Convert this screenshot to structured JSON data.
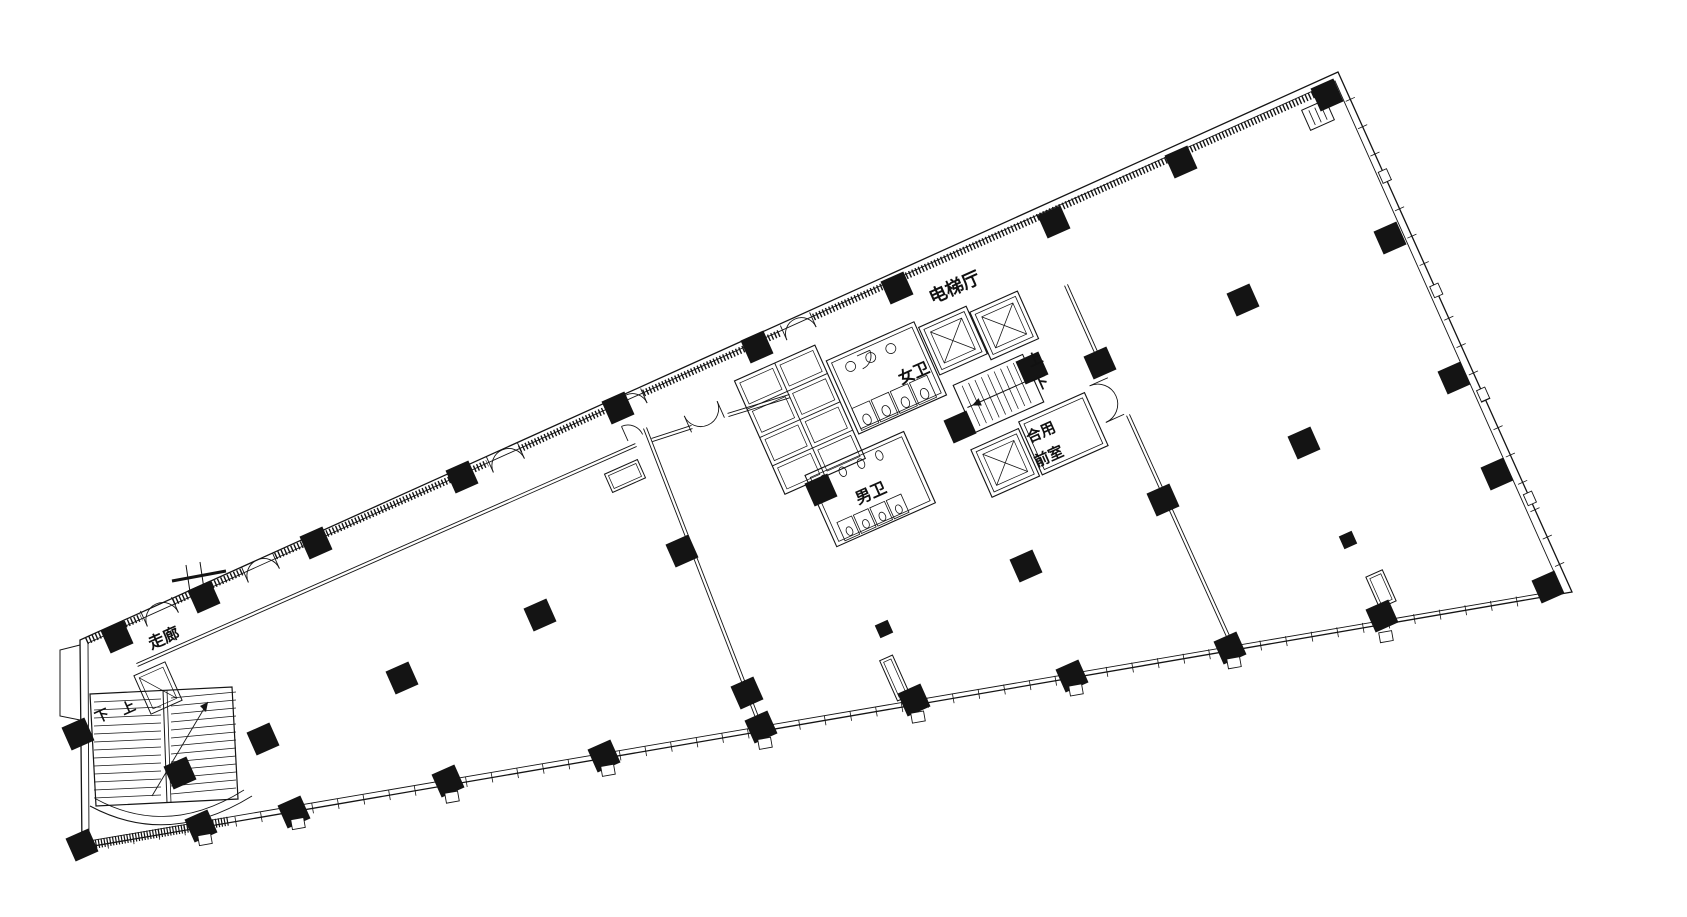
{
  "labels": {
    "elevator_hall": "电梯厅",
    "womens_wc": "女卫",
    "mens_wc": "男卫",
    "shared_vestibule_line1": "合用",
    "shared_vestibule_line2": "前室",
    "core_up": "上",
    "core_down": "下",
    "corridor": "走廊",
    "bl_down": "下",
    "bl_up": "上"
  },
  "plan": {
    "stroke": "#141414",
    "bg": "#ffffff",
    "canvas": [
      1687,
      917
    ],
    "outline_outer": [
      [
        80,
        640
      ],
      [
        82,
        848
      ],
      [
        1572,
        592
      ],
      [
        1338,
        72
      ]
    ],
    "outline_inner": [
      [
        88,
        643
      ],
      [
        89,
        841
      ],
      [
        1562,
        590
      ],
      [
        1335,
        81
      ]
    ],
    "notch": [
      [
        80,
        645
      ],
      [
        60,
        650
      ],
      [
        60,
        716
      ],
      [
        80,
        720
      ]
    ],
    "curtain_segments": [
      [
        85,
        638,
        140,
        614
      ],
      [
        172,
        599,
        242,
        568
      ],
      [
        274,
        553,
        486,
        460
      ],
      [
        518,
        446,
        608,
        405
      ],
      [
        642,
        390,
        778,
        330
      ],
      [
        812,
        314,
        1320,
        88
      ]
    ],
    "tick_edges": [
      {
        "x1": 82,
        "y1": 848,
        "x2": 1572,
        "y2": 592,
        "step": 26,
        "len": 10
      },
      {
        "x1": 1338,
        "y1": 72,
        "x2": 1572,
        "y2": 592,
        "step": 30,
        "len": 10
      }
    ],
    "partitions": [
      [
        645,
        428,
        760,
        725
      ],
      [
        1066,
        285,
        1104,
        370
      ],
      [
        1128,
        415,
        1232,
        645
      ],
      [
        137,
        665,
        636,
        445
      ],
      [
        652,
        440,
        692,
        427
      ],
      [
        728,
        415,
        790,
        396
      ]
    ],
    "doors": [
      {
        "x": 156,
        "y": 604,
        "a": 156,
        "r": 17,
        "d": 2
      },
      {
        "x": 257,
        "y": 560,
        "a": 156,
        "r": 17,
        "d": 2
      },
      {
        "x": 502,
        "y": 450,
        "a": 156,
        "r": 17,
        "d": 2
      },
      {
        "x": 626,
        "y": 395,
        "a": 156,
        "r": 16,
        "d": 2
      },
      {
        "x": 795,
        "y": 319,
        "a": 156,
        "r": 16,
        "d": 2
      },
      {
        "x": 628,
        "y": 441,
        "a": -24,
        "r": 16,
        "d": 1
      },
      {
        "x": 708,
        "y": 425,
        "a": -24,
        "r": 18,
        "d": 2
      },
      {
        "x": 857,
        "y": 356,
        "a": 66,
        "r": 14,
        "d": 1
      },
      {
        "x": 1116,
        "y": 396,
        "a": -114,
        "r": 20,
        "d": 2
      }
    ],
    "columns": [
      [
        117,
        637
      ],
      [
        204,
        597
      ],
      [
        316,
        543
      ],
      [
        462,
        477
      ],
      [
        618,
        408
      ],
      [
        757,
        347
      ],
      [
        897,
        288
      ],
      [
        1054,
        222
      ],
      [
        1181,
        162
      ],
      [
        1327,
        95
      ],
      [
        1390,
        238
      ],
      [
        1454,
        378
      ],
      [
        1497,
        474
      ],
      [
        1548,
        587
      ],
      [
        82,
        845
      ],
      [
        201,
        826
      ],
      [
        294,
        812
      ],
      [
        448,
        781
      ],
      [
        604,
        756
      ],
      [
        761,
        727
      ],
      [
        914,
        700
      ],
      [
        1072,
        676
      ],
      [
        1230,
        648
      ],
      [
        1382,
        616
      ],
      [
        263,
        739
      ],
      [
        402,
        678
      ],
      [
        540,
        615
      ],
      [
        682,
        551
      ],
      [
        747,
        693
      ],
      [
        1026,
        566
      ],
      [
        1243,
        300
      ],
      [
        1304,
        443
      ],
      [
        1032,
        368
      ],
      [
        1100,
        363
      ],
      [
        821,
        490
      ],
      [
        1163,
        500
      ],
      [
        180,
        773
      ],
      [
        78,
        734
      ],
      [
        960,
        427
      ]
    ],
    "columns_small": [
      [
        884,
        629
      ],
      [
        1348,
        540
      ]
    ],
    "window_squares_bottom_x": [
      201,
      294,
      448,
      604,
      761,
      914,
      1072,
      1230,
      1382
    ],
    "right_squares": [
      0.2,
      0.42,
      0.62,
      0.82
    ],
    "core": {
      "cx": 940,
      "cy": 400,
      "angle": -24,
      "rooms": [
        {
          "t": "shaft",
          "x": 950,
          "y": 325,
          "w": 52,
          "h": 52
        },
        {
          "t": "shaft",
          "x": 1003,
          "y": 332,
          "w": 52,
          "h": 52
        },
        {
          "t": "stair",
          "x": 958,
          "y": 392,
          "w": 76,
          "h": 52
        },
        {
          "t": "shaft",
          "x": 948,
          "y": 458,
          "w": 52,
          "h": 52
        },
        {
          "t": "room",
          "x": 1003,
          "y": 452,
          "w": 72,
          "h": 58
        },
        {
          "t": "room",
          "x": 852,
          "y": 318,
          "w": 96,
          "h": 80
        },
        {
          "t": "room",
          "x": 786,
          "y": 414,
          "w": 108,
          "h": 78
        },
        {
          "t": "grid",
          "x": 760,
          "y": 299,
          "w": 88,
          "h": 124,
          "cols": 2,
          "rows": 4
        }
      ],
      "stalls_f": {
        "x": 856,
        "y": 372,
        "n": 4,
        "w": 21,
        "h": 24
      },
      "sinks_f": {
        "x": 872,
        "y": 333,
        "n": 3,
        "s": 22
      },
      "urinals_m": {
        "x": 802,
        "y": 426,
        "n": 4,
        "s": 20
      },
      "stalls_m": {
        "x": 796,
        "y": 470,
        "n": 4,
        "w": 18,
        "h": 20
      }
    },
    "stubs": [
      {
        "x": 625,
        "y": 476,
        "w": 36,
        "h": 20,
        "a": -24
      },
      {
        "x": 895,
        "y": 678,
        "w": 14,
        "h": 44,
        "a": -24
      },
      {
        "x": 1381,
        "y": 589,
        "w": 18,
        "h": 34,
        "a": -24
      }
    ],
    "bl_stair": {
      "outer": [
        [
          90,
          694
        ],
        [
          232,
          687
        ],
        [
          238,
          799
        ],
        [
          96,
          806
        ]
      ],
      "div": [
        163,
        690,
        167,
        803
      ],
      "treadsA": {
        "x1": 94,
        "x2": 161,
        "y0": 702,
        "y1": 798,
        "step": 8,
        "drop": 3
      },
      "treadsB": {
        "x1": 171,
        "x2": 236,
        "y0": 698,
        "y1": 796,
        "step": 8,
        "drop": 6
      },
      "arrow": [
        152,
        796,
        208,
        702
      ],
      "curve1": "M90,806 Q168,848 252,796",
      "curve2": "M96,799 Q168,838 244,790",
      "shaft": {
        "cx": 158,
        "cy": 688,
        "w": 34,
        "h": 42
      }
    },
    "cut_mark": {
      "bar": [
        172,
        581,
        226,
        571
      ],
      "t1": [
        186,
        565,
        190,
        592
      ],
      "t2": [
        200,
        562,
        204,
        589
      ]
    },
    "corner_box": {
      "cx": 1318,
      "cy": 115,
      "w": 26,
      "h": 22
    },
    "bottom_hatch": [
      84,
      846,
      229,
      821
    ]
  }
}
